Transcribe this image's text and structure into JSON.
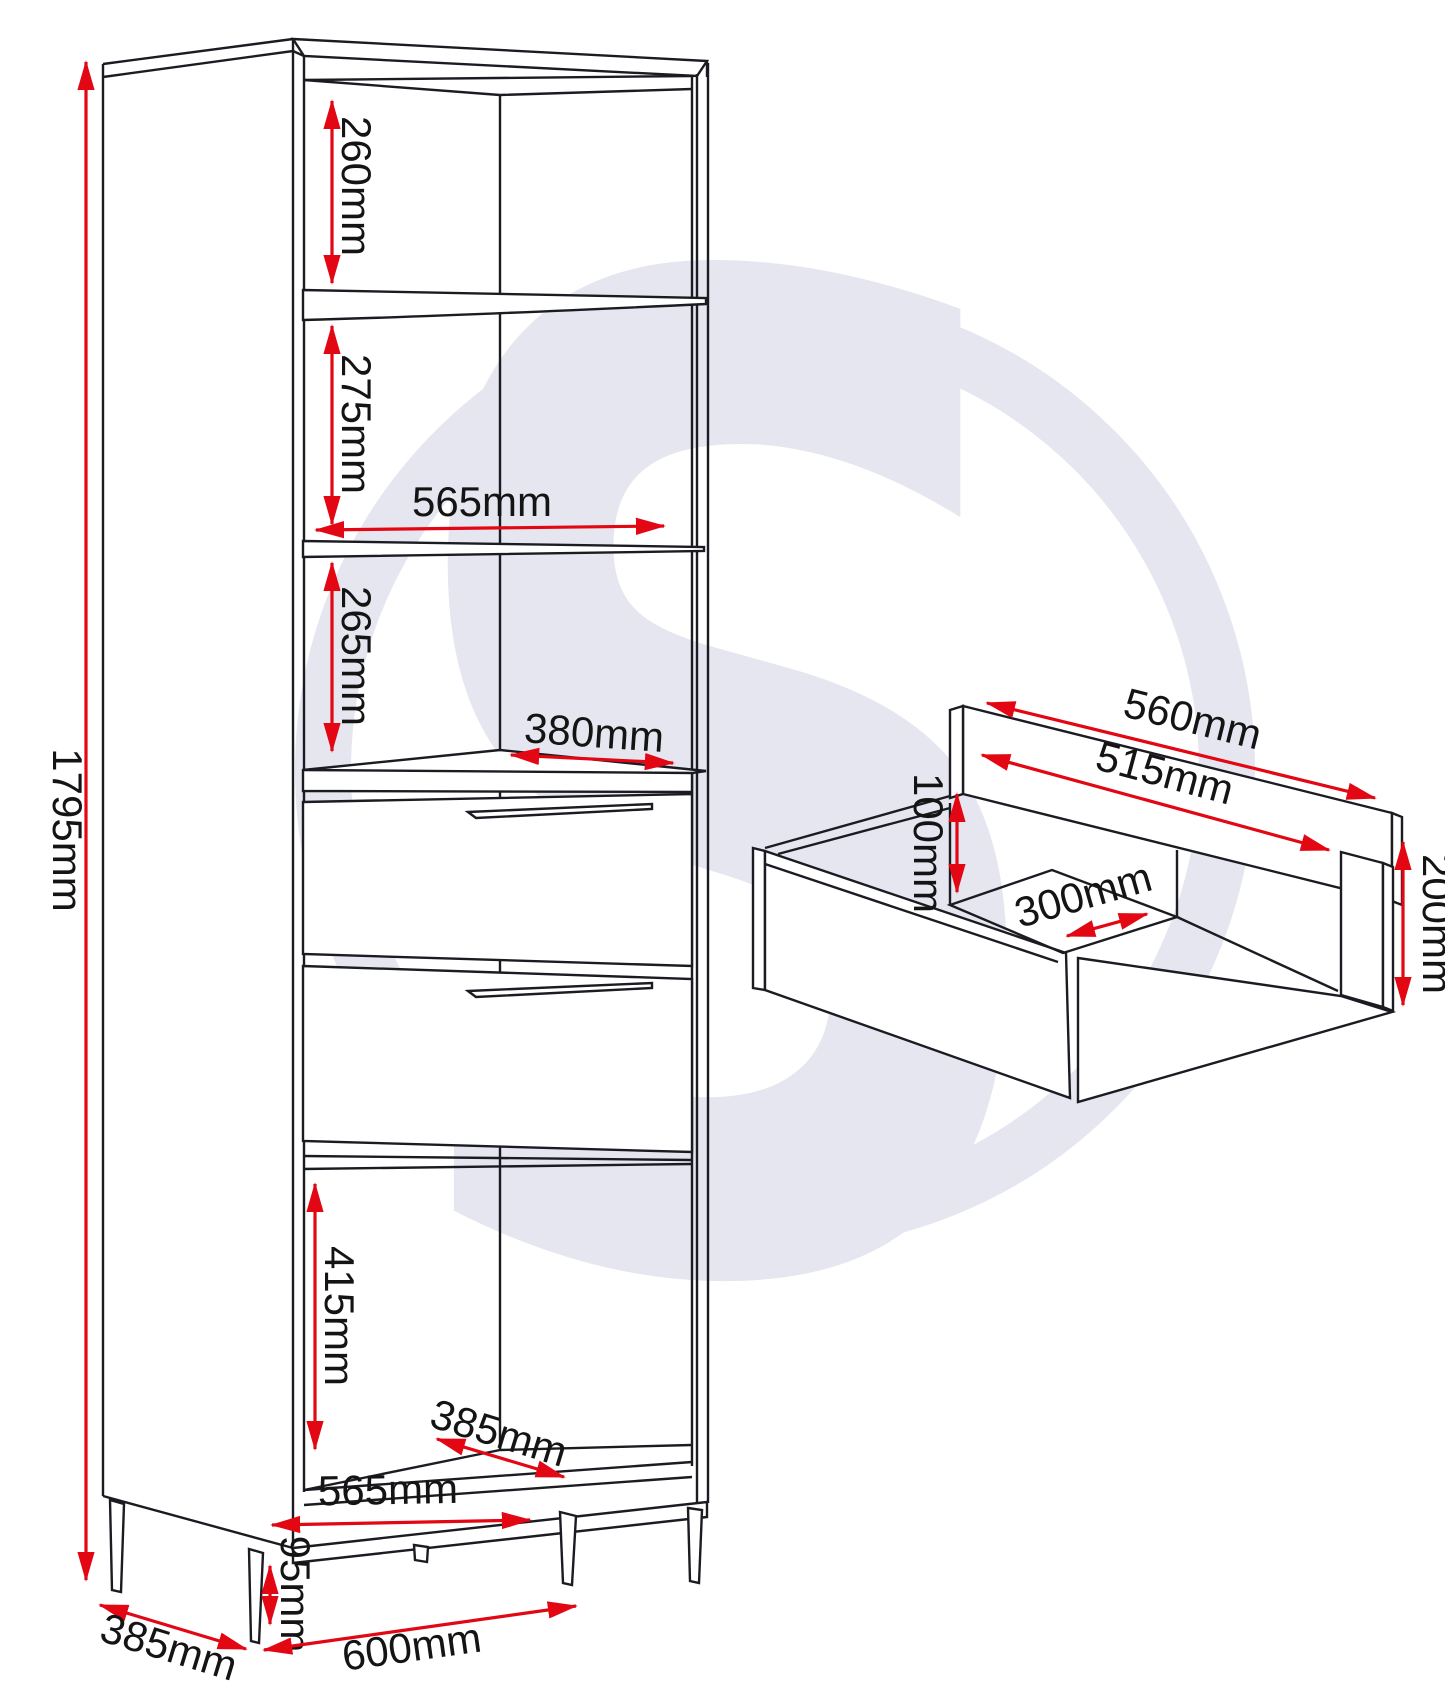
{
  "page": {
    "background": "#ffffff"
  },
  "colors": {
    "line": "#1b1b22",
    "dimension_red": "#e30613",
    "text": "#141414",
    "watermark": "#e6e6f0"
  },
  "watermark": {
    "letter": "S"
  },
  "cabinet": {
    "name": "Tall shelving unit with two drawers - dimension drawing",
    "dims": {
      "overall_height": "1795mm",
      "top_section_height": "260mm",
      "second_section_height": "275mm",
      "interior_width": "565mm",
      "third_section_height": "265mm",
      "drawer_top_depth": "380mm",
      "lower_section_height": "415mm",
      "interior_depth": "385mm",
      "interior_bottom_width": "565mm",
      "leg_height": "95mm",
      "overall_depth": "385mm",
      "overall_width": "600mm"
    }
  },
  "drawer": {
    "name": "Drawer box - dimension drawing",
    "dims": {
      "back_panel_width": "560mm",
      "interior_width": "515mm",
      "interior_height": "100mm",
      "interior_depth": "300mm",
      "front_panel_height": "200mm"
    }
  }
}
